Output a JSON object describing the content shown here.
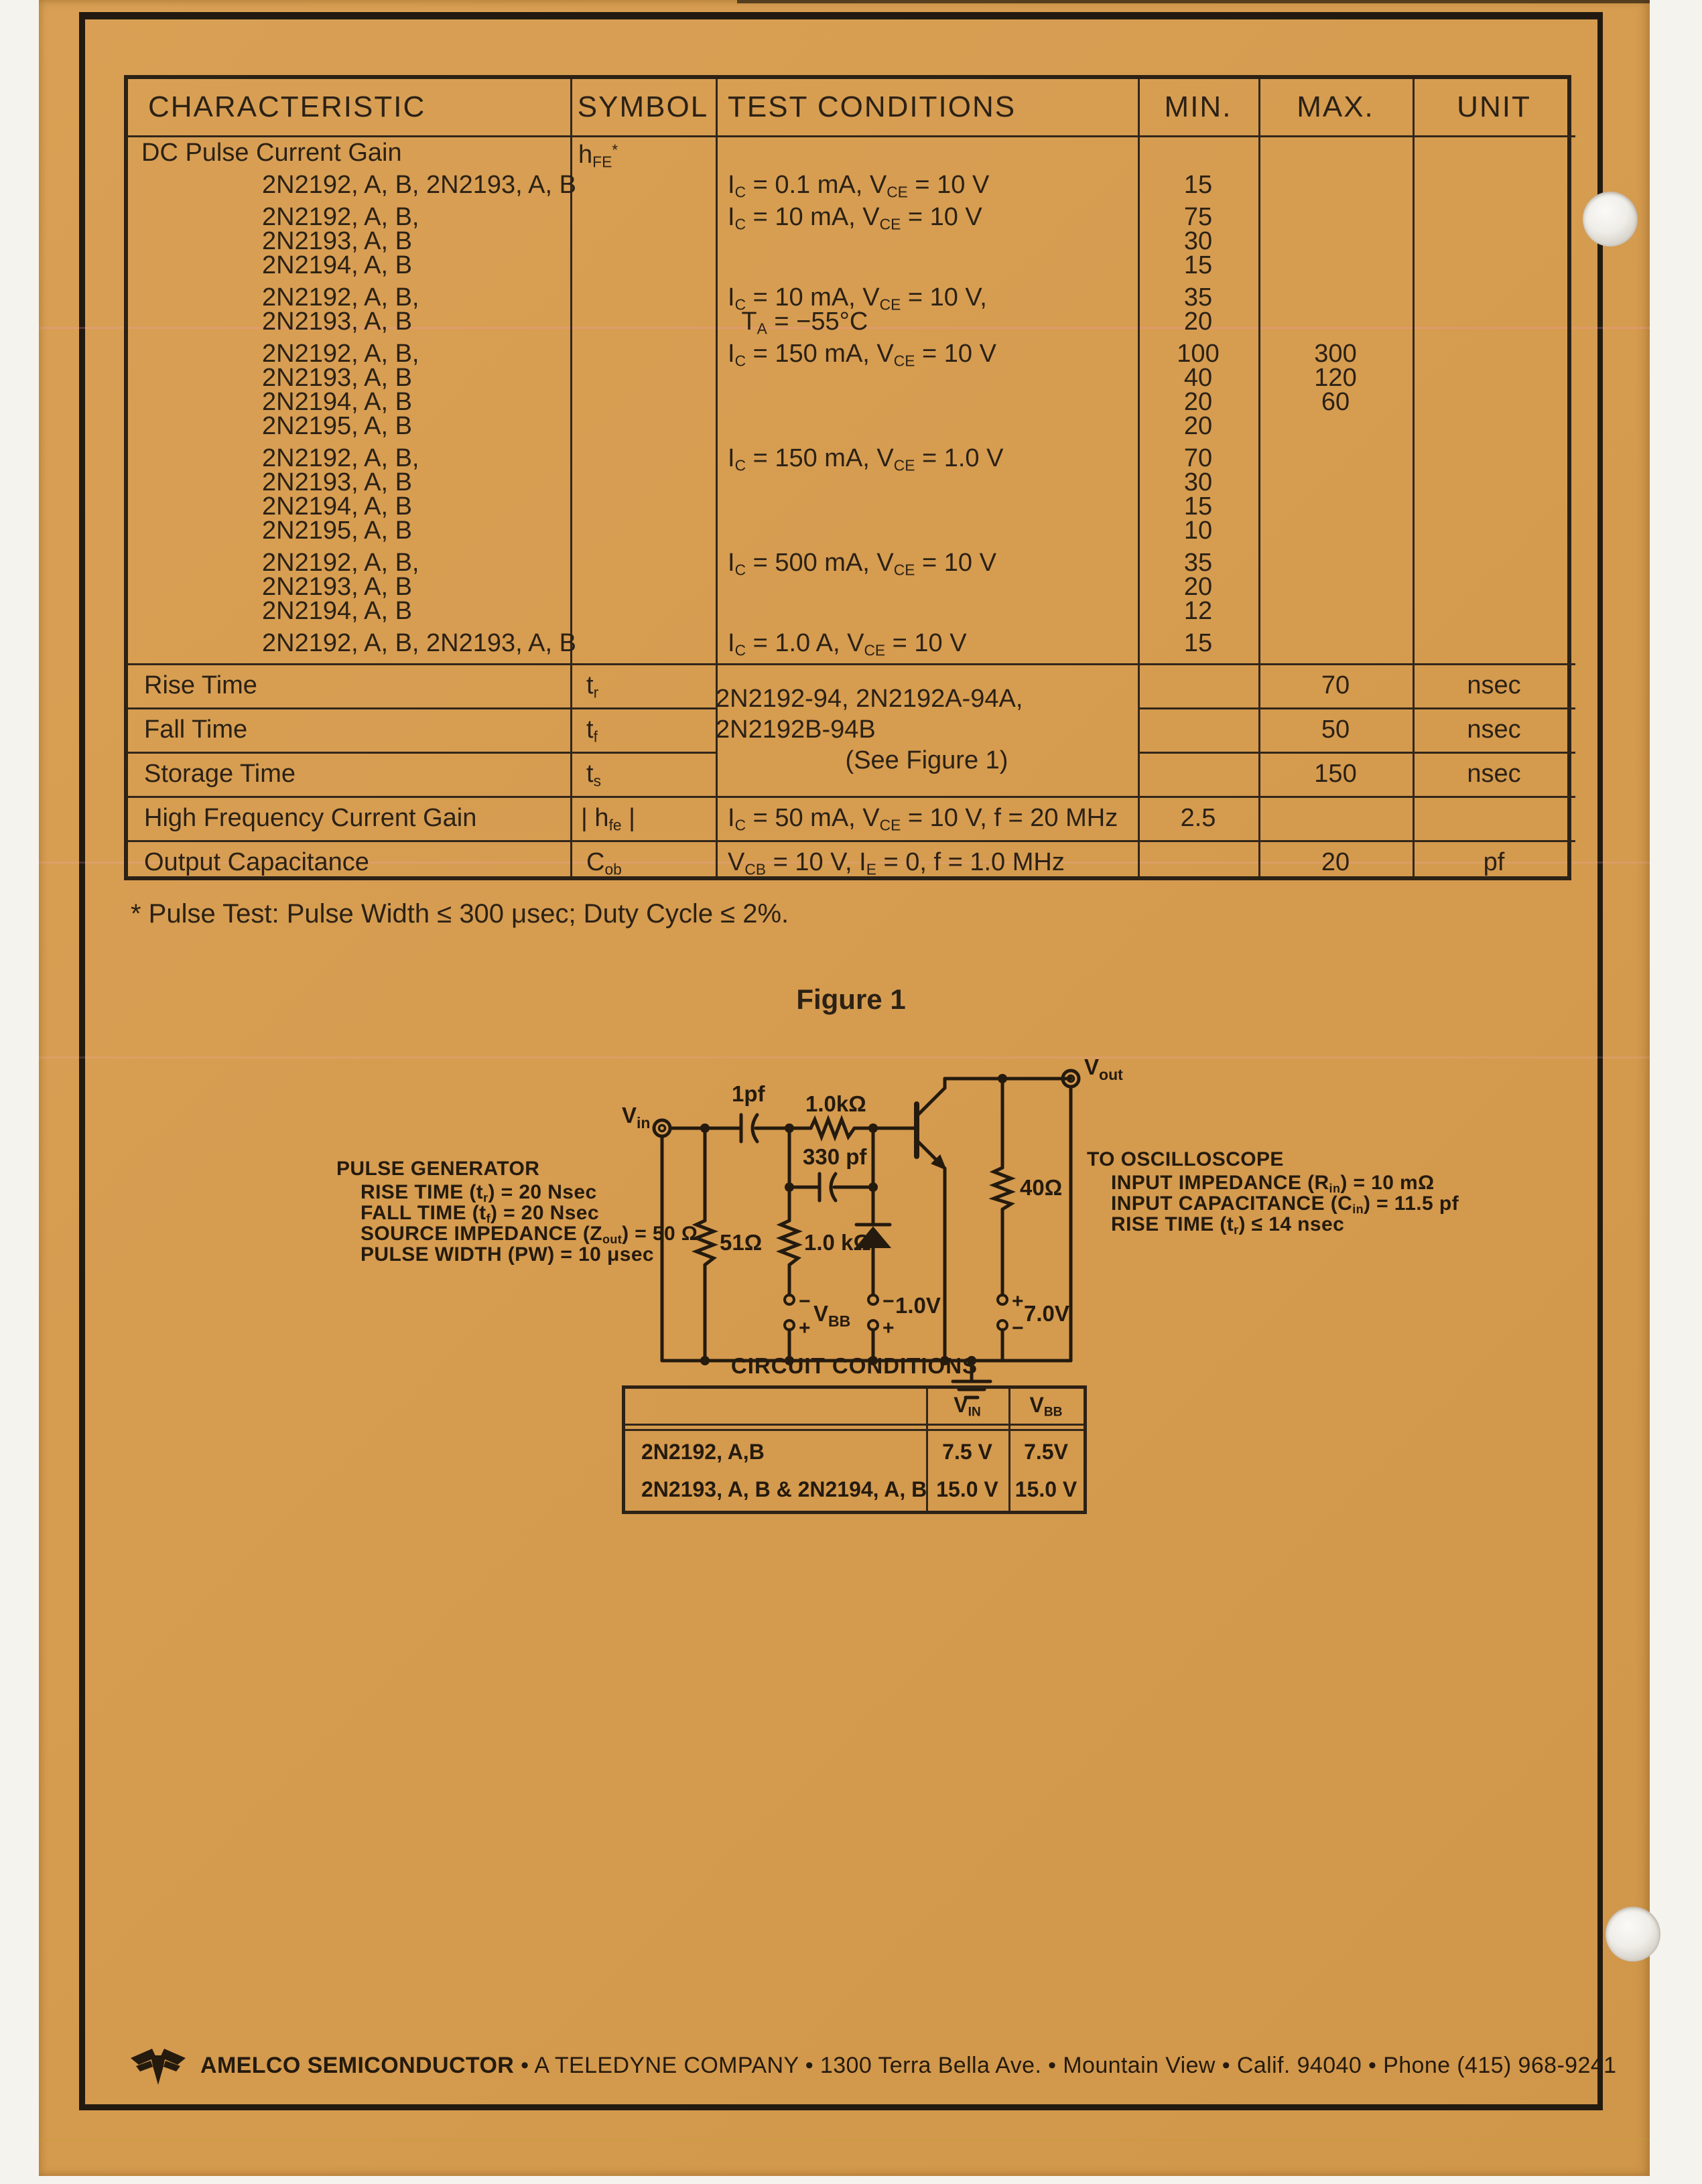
{
  "colors": {
    "paper": "#d79e52",
    "ink": "#2b2115",
    "line": "#32261a",
    "scanner_white": "#f5f3ee"
  },
  "spec_table": {
    "headers": {
      "characteristic": "CHARACTERISTIC",
      "symbol": "SYMBOL",
      "test_conditions": "TEST CONDITIONS",
      "min": "MIN.",
      "max": "MAX.",
      "unit": "UNIT"
    },
    "hfe": {
      "name": "DC Pulse Current Gain",
      "symbol": "h_{FE}^{*}",
      "groups": [
        {
          "models": [
            "2N2192, A, B, 2N2193, A, B"
          ],
          "condition": [
            "I_{C} = 0.1 mA, V_{CE} = 10 V"
          ],
          "min": [
            "15"
          ],
          "max": []
        },
        {
          "models": [
            "2N2192, A, B,",
            "2N2193, A, B",
            "2N2194, A, B"
          ],
          "condition": [
            "I_{C} = 10 mA, V_{CE} = 10 V"
          ],
          "min": [
            "75",
            "30",
            "15"
          ],
          "max": []
        },
        {
          "models": [
            "2N2192, A, B,",
            "2N2193, A, B"
          ],
          "condition": [
            "I_{C} = 10 mA, V_{CE} = 10 V,",
            "  T_{A} = −55°C"
          ],
          "min": [
            "35",
            "20"
          ],
          "max": []
        },
        {
          "models": [
            "2N2192, A, B,",
            "2N2193, A, B",
            "2N2194, A, B",
            "2N2195, A, B"
          ],
          "condition": [
            "I_{C} = 150 mA, V_{CE} = 10 V"
          ],
          "min": [
            "100",
            "40",
            "20",
            "20"
          ],
          "max": [
            "300",
            "120",
            "60"
          ]
        },
        {
          "models": [
            "2N2192, A, B,",
            "2N2193, A, B",
            "2N2194, A, B",
            "2N2195, A, B"
          ],
          "condition": [
            "I_{C} = 150 mA, V_{CE} = 1.0 V"
          ],
          "min": [
            "70",
            "30",
            "15",
            "10"
          ],
          "max": []
        },
        {
          "models": [
            "2N2192, A, B,",
            "2N2193, A, B",
            "2N2194, A, B"
          ],
          "condition": [
            "I_{C} = 500 mA, V_{CE} = 10 V"
          ],
          "min": [
            "35",
            "20",
            "12"
          ],
          "max": []
        },
        {
          "models": [
            "2N2192, A, B, 2N2193, A, B"
          ],
          "condition": [
            "I_{C} = 1.0 A, V_{CE} = 10 V"
          ],
          "min": [
            "15"
          ],
          "max": []
        }
      ]
    },
    "switching_note": [
      "2N2192-94, 2N2192A-94A, 2N2192B-94B",
      "(See Figure 1)"
    ],
    "rows": [
      {
        "name": "Rise Time",
        "symbol": "t_{r}",
        "condition": "",
        "min": "",
        "max": "70",
        "unit": "nsec"
      },
      {
        "name": "Fall Time",
        "symbol": "t_{f}",
        "condition": "",
        "min": "",
        "max": "50",
        "unit": "nsec"
      },
      {
        "name": "Storage Time",
        "symbol": "t_{s}",
        "condition": "",
        "min": "",
        "max": "150",
        "unit": "nsec"
      },
      {
        "name": "High Frequency Current Gain",
        "symbol": "| h_{fe} |",
        "condition": "I_{C} = 50 mA, V_{CE} = 10 V, f = 20 MHz",
        "min": "2.5",
        "max": "",
        "unit": ""
      },
      {
        "name": "Output Capacitance",
        "symbol": "C_{ob}",
        "condition": "V_{CB} = 10 V, I_{E} = 0, f = 1.0 MHz",
        "min": "",
        "max": "20",
        "unit": "pf"
      }
    ]
  },
  "footnote": "* Pulse Test: Pulse Width ≤ 300 μsec; Duty Cycle ≤ 2%.",
  "figure": {
    "title": "Figure 1",
    "pulse_generator": {
      "title": "PULSE GENERATOR",
      "lines": [
        "RISE TIME (t_{r}) = 20 Nsec",
        "FALL TIME (t_{f}) = 20 Nsec",
        "SOURCE IMPEDANCE (Z_{out}) = 50 Ω",
        "PULSE WIDTH (PW) = 10 μsec"
      ]
    },
    "oscilloscope": {
      "title": "TO OSCILLOSCOPE",
      "lines": [
        "INPUT IMPEDANCE (R_{in}) = 10 mΩ",
        "INPUT CAPACITANCE (C_{in}) = 11.5 pf",
        "RISE TIME (t_{r}) ≤ 14 nsec"
      ]
    },
    "labels": {
      "vin_main": "V",
      "vin_sub": "in",
      "vout_main": "V",
      "vout_sub": "out",
      "coupling_cap": "1pf",
      "series_resistor": "1.0kΩ",
      "speedup_cap": "330 pf",
      "shunt_resistor": "51Ω",
      "base_resistor": "1.0 kΩ",
      "load_resistor": "40Ω",
      "vbb_main": "V",
      "vbb_sub": "BB",
      "diode_bias": "1.0V",
      "collector_supply": "7.0V",
      "plus": "+",
      "minus": "−"
    }
  },
  "conditions_table": {
    "title": "CIRCUIT CONDITIONS",
    "col_vin_main": "V",
    "col_vin_sub": "IN",
    "col_vbb_main": "V",
    "col_vbb_sub": "BB",
    "rows": [
      {
        "device": "2N2192, A,B",
        "vin": "7.5 V",
        "vbb": "7.5V"
      },
      {
        "device": "2N2193, A, B & 2N2194, A, B",
        "vin": "15.0 V",
        "vbb": "15.0 V"
      }
    ]
  },
  "footer": {
    "brand": "AMELCO SEMICONDUCTOR",
    "rest": " • A TELEDYNE COMPANY • 1300 Terra Bella Ave. • Mountain View • Calif. 94040 • Phone (415) 968-9241"
  }
}
